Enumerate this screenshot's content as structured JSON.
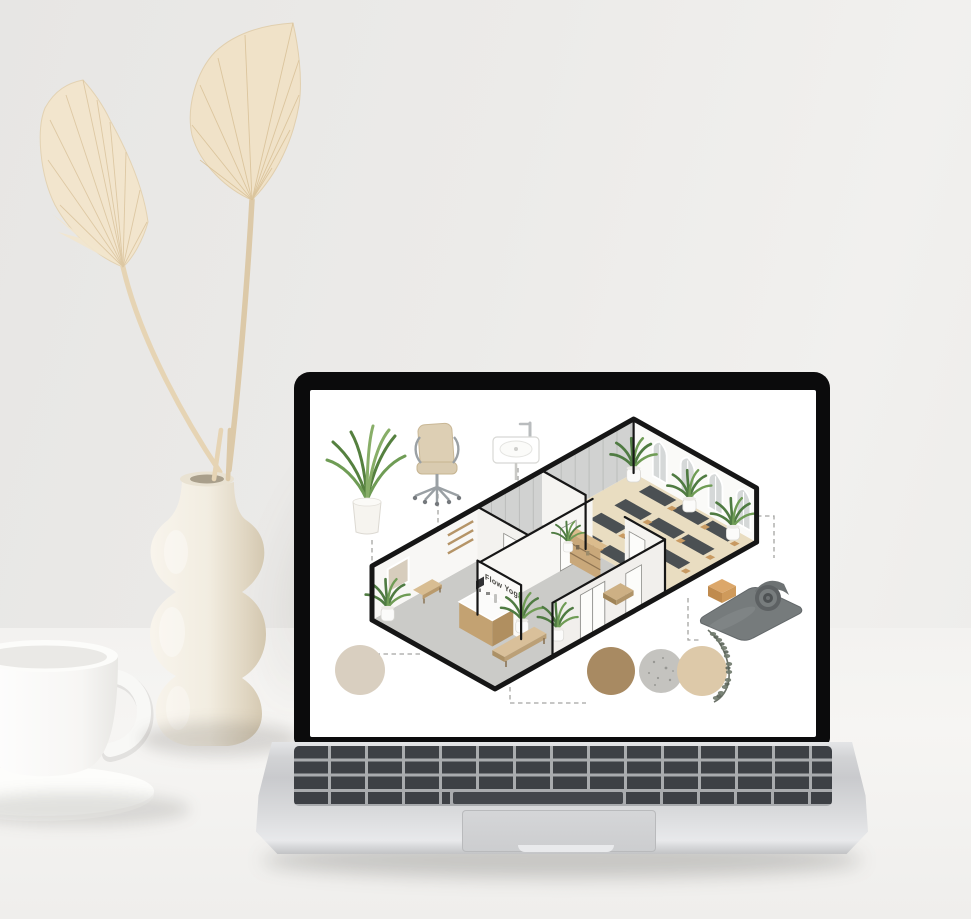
{
  "scene": {
    "setting": "Minimal white desk: laptop showing an isometric yoga-studio floor plan mood board, sculptural ceramic vase with two dried palm spear leaves, white coffee mug on a saucer",
    "objects": [
      "dried-palm-leaves",
      "ceramic-vase",
      "coffee-mug",
      "saucer",
      "laptop"
    ]
  },
  "laptop": {
    "parts": [
      "screen-bezel",
      "display",
      "hinge",
      "keyboard",
      "trackpad",
      "base"
    ]
  },
  "screen_content": {
    "subject": "Isometric cutaway floor plan and material mood board of a yoga studio",
    "sign_label": "Flow Yoga",
    "rooms": [
      {
        "name": "reception",
        "floor": "grey concrete",
        "furniture": [
          "wall-art",
          "wall-shelves",
          "wall-bench",
          "reception-desk",
          "long-bench",
          "potted-plants"
        ]
      },
      {
        "name": "hallway",
        "furniture": [
          "single-doors",
          "double-entry-doors",
          "storage-cubby",
          "potted-plant"
        ]
      },
      {
        "name": "yoga-studio",
        "floor": "light wood",
        "yoga_mats": 12,
        "arched_windows": 4,
        "potted_plants": 3
      }
    ],
    "legend_items": [
      "potted-plant",
      "office-chair",
      "wall-basin",
      "cork-yoga-block",
      "rolled-yoga-mat",
      "eucalyptus-sprig"
    ],
    "material_swatches": [
      {
        "name": "cream-plaster",
        "color": "#d9cfc0"
      },
      {
        "name": "warm-oak-wood",
        "color": "#a88a62"
      },
      {
        "name": "terrazzo-stone",
        "color": "#c4c3bf"
      },
      {
        "name": "sand-linen",
        "color": "#ddc9a9"
      }
    ],
    "palette": {
      "outline": "#161616",
      "studio_floor": "#e9ddc1",
      "reception_floor": "#cbcbc8",
      "mat": "#4b5053",
      "mat_block": "#c89a62",
      "wood": "#c7a77b",
      "plant_green": "#55803f"
    }
  }
}
